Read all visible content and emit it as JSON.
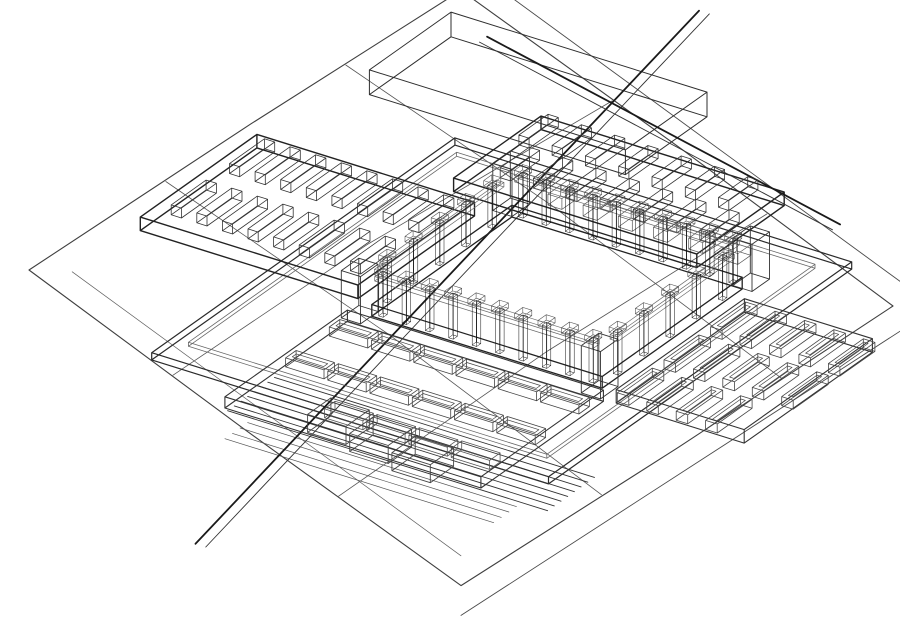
{
  "meta": {
    "title": "Axonometric wireframe site model",
    "description": "CAD hidden-line wireframe axonometric of a courtyard building complex on a terraced terrain diamond"
  },
  "canvas": {
    "width": 900,
    "height": 638,
    "background": "#ffffff"
  },
  "palette": {
    "line_dark": "#222222",
    "line_mid": "#4a4a4a",
    "line_light": "#6f6f6f",
    "column_fill": "#262626",
    "courtyard_fill": "#ffffff"
  },
  "groups": {
    "t": {
      "o": [
        461,
        288
      ],
      "a": [
        3.6,
        -2.33
      ],
      "b": [
        3.6,
        2.63
      ],
      "zs": 4.5
    },
    "b": {
      "o": [
        557,
        308
      ],
      "a": [
        6.4,
        2.0
      ],
      "b": [
        -5.83,
        4.13
      ],
      "zs": 4.5
    }
  },
  "elements": [
    {
      "k": "poly",
      "g": "t",
      "w": 1.1,
      "c": "#3f3f3f",
      "closed": true,
      "pts": [
        [
          -60,
          -60,
          0
        ],
        [
          2,
          -60.5,
          0
        ],
        [
          60,
          -60,
          0
        ],
        [
          60.5,
          1,
          0
        ],
        [
          60,
          60,
          0
        ],
        [
          0,
          60.5,
          0
        ],
        [
          -60,
          60,
          0
        ],
        [
          -60.4,
          0,
          0
        ]
      ]
    },
    {
      "k": "poly",
      "g": "t",
      "w": 0.9,
      "c": "#4a4a4a",
      "pts": [
        [
          66,
          -66,
          0
        ],
        [
          66,
          66,
          0
        ],
        [
          -66,
          66,
          0
        ]
      ]
    },
    {
      "k": "poly",
      "g": "t",
      "w": 0.8,
      "c": "#555555",
      "pts": [
        [
          -60,
          -20,
          0
        ],
        [
          -5,
          -21,
          0
        ],
        [
          60,
          -18,
          0
        ]
      ]
    },
    {
      "k": "poly",
      "g": "t",
      "w": 0.8,
      "c": "#555555",
      "pts": [
        [
          -60,
          26,
          0
        ],
        [
          0,
          24,
          0
        ],
        [
          60,
          25,
          0
        ]
      ]
    },
    {
      "k": "poly",
      "g": "t",
      "w": 0.8,
      "c": "#555555",
      "pts": [
        [
          -22,
          -60,
          0
        ],
        [
          -20,
          0,
          0
        ],
        [
          -21,
          60,
          0
        ]
      ]
    },
    {
      "k": "poly",
      "g": "t",
      "w": 0.8,
      "c": "#555555",
      "pts": [
        [
          28,
          -60,
          0
        ],
        [
          30,
          -5,
          0
        ],
        [
          29,
          60,
          0
        ]
      ]
    },
    {
      "k": "poly",
      "g": "t",
      "w": 0.7,
      "c": "#606060",
      "pts": [
        [
          -54,
          -54,
          0
        ],
        [
          -54,
          54,
          0
        ]
      ]
    },
    {
      "k": "box",
      "g": "b",
      "w": 1.2,
      "c": "#2a2a2a",
      "min": [
        -36,
        -22,
        0
      ],
      "size": [
        62,
        52,
        1.6
      ]
    },
    {
      "k": "box",
      "g": "b",
      "w": 0.8,
      "c": "#666666",
      "min": [
        -33,
        -19,
        1.6
      ],
      "size": [
        56,
        46,
        0.9
      ]
    },
    {
      "k": "lines",
      "g": "b",
      "w": 0.9,
      "c": "#333333",
      "from": [
        -20,
        26.5,
        0
      ],
      "to": [
        30,
        26.5,
        0
      ],
      "count": 8,
      "step": [
        0,
        1.15,
        0
      ]
    },
    {
      "k": "lines",
      "g": "b",
      "w": 0.7,
      "c": "#555555",
      "from": [
        -16,
        35.5,
        0
      ],
      "to": [
        26,
        35.5,
        0
      ],
      "count": 4,
      "step": [
        0,
        1.3,
        0
      ]
    },
    {
      "k": "box",
      "g": "b",
      "w": 1.4,
      "c": "#222222",
      "min": [
        -56,
        -10,
        1.5
      ],
      "size": [
        34,
        20,
        3
      ]
    },
    {
      "k": "box",
      "g": "b",
      "w": 1.4,
      "c": "#222222",
      "min": [
        -28,
        -28,
        1.5
      ],
      "size": [
        38,
        15,
        3
      ]
    },
    {
      "k": "box",
      "g": "b",
      "w": 1.1,
      "c": "#333333",
      "min": [
        22,
        -8,
        1.5
      ],
      "size": [
        20,
        22,
        3
      ]
    },
    {
      "k": "box",
      "g": "b",
      "w": 1.1,
      "c": "#333333",
      "min": [
        -20,
        14,
        1
      ],
      "size": [
        40,
        21,
        2.5
      ]
    },
    {
      "k": "box",
      "g": "b",
      "w": 1.0,
      "c": "#2e2e2e",
      "min": [
        -53,
        -40,
        0
      ],
      "size": [
        40,
        14,
        5.5
      ]
    },
    {
      "k": "poly",
      "g": "b",
      "w": 1.8,
      "c": "#1a1a1a",
      "pts": [
        [
          0,
          62,
          4.5
        ],
        [
          -27,
          -54,
          4.5
        ]
      ]
    },
    {
      "k": "poly",
      "g": "b",
      "w": 0.9,
      "c": "#333333",
      "pts": [
        [
          1.6,
          62,
          4.5
        ],
        [
          -25.4,
          -54,
          4.5
        ]
      ]
    },
    {
      "k": "poly",
      "g": "b",
      "w": 1.8,
      "c": "#1a1a1a",
      "pts": [
        [
          -46,
          -38.5,
          4.5
        ],
        [
          21,
          -25.5,
          4.5
        ]
      ]
    },
    {
      "k": "poly",
      "g": "b",
      "w": 0.9,
      "c": "#333333",
      "pts": [
        [
          -46,
          -37.2,
          4.5
        ],
        [
          21,
          -24.2,
          4.5
        ]
      ]
    },
    {
      "k": "row",
      "g": "b",
      "w": 0.8,
      "c": "#333333",
      "min": [
        -53,
        -8,
        4.5
      ],
      "size": [
        1.6,
        6,
        2.2
      ],
      "count": 8,
      "step": [
        4,
        0,
        0
      ]
    },
    {
      "k": "row",
      "g": "b",
      "w": 0.8,
      "c": "#333333",
      "min": [
        -53,
        2,
        4.5
      ],
      "size": [
        1.6,
        6,
        2.2
      ],
      "count": 8,
      "step": [
        4,
        0,
        0
      ]
    },
    {
      "k": "row",
      "g": "b",
      "w": 0.8,
      "c": "#333333",
      "min": [
        -26,
        -27,
        4.5
      ],
      "size": [
        1.6,
        5,
        2.2
      ],
      "count": 7,
      "step": [
        5.2,
        0,
        0
      ]
    },
    {
      "k": "row",
      "g": "b",
      "w": 0.8,
      "c": "#333333",
      "min": [
        -23,
        -20.5,
        4.5
      ],
      "size": [
        1.6,
        5,
        2.2
      ],
      "count": 7,
      "step": [
        5.2,
        0,
        0
      ]
    },
    {
      "k": "row",
      "g": "b",
      "w": 0.8,
      "c": "#444444",
      "inner": 0.55,
      "min": [
        24,
        -6,
        4.5
      ],
      "size": [
        1.8,
        6,
        2
      ],
      "count": 5,
      "step": [
        4.6,
        0,
        0
      ]
    },
    {
      "k": "row",
      "g": "b",
      "w": 0.8,
      "c": "#444444",
      "inner": 0.55,
      "min": [
        24,
        2,
        4.5
      ],
      "size": [
        1.8,
        6,
        2
      ],
      "count": 5,
      "step": [
        4.6,
        0,
        0
      ]
    },
    {
      "k": "row",
      "g": "b",
      "w": 0.8,
      "c": "#444444",
      "inner": 0.55,
      "min": [
        24,
        10,
        4.5
      ],
      "size": [
        1.8,
        6,
        2
      ],
      "count": 4,
      "step": [
        4.6,
        0,
        0
      ]
    },
    {
      "k": "row",
      "g": "b",
      "w": 0.8,
      "c": "#444444",
      "inner": 0.55,
      "min": [
        -18,
        17.5,
        3.5
      ],
      "size": [
        6,
        1.8,
        2
      ],
      "count": 6,
      "step": [
        6.6,
        0,
        0
      ]
    },
    {
      "k": "row",
      "g": "b",
      "w": 0.8,
      "c": "#444444",
      "inner": 0.55,
      "min": [
        -18,
        25,
        3.5
      ],
      "size": [
        6,
        1.8,
        2
      ],
      "count": 6,
      "step": [
        6.6,
        0,
        0
      ]
    },
    {
      "k": "row",
      "g": "b",
      "w": 0.8,
      "c": "#555555",
      "min": [
        -6,
        31.5,
        3.5
      ],
      "size": [
        6,
        1.8,
        2
      ],
      "count": 4,
      "step": [
        6.6,
        0,
        0
      ]
    },
    {
      "k": "row",
      "g": "b",
      "w": 0.7,
      "c": "#555555",
      "min": [
        -14,
        -16,
        4
      ],
      "size": [
        2.2,
        2.2,
        2.4
      ],
      "count": 6,
      "step": [
        5.5,
        0,
        0
      ]
    },
    {
      "k": "row",
      "g": "b",
      "w": 0.9,
      "c": "#444444",
      "min": [
        -8,
        30,
        0
      ],
      "size": [
        6,
        4,
        4
      ],
      "count": 3,
      "step": [
        7.5,
        1,
        0
      ]
    },
    {
      "k": "box",
      "g": "b",
      "w": 1.3,
      "c": "#222222",
      "topFill": "#ffffff",
      "min": [
        -18,
        -12,
        1.2
      ],
      "size": [
        36,
        24,
        2.6
      ]
    },
    {
      "k": "box",
      "g": "b",
      "w": 0.9,
      "c": "#333333",
      "min": [
        -20.5,
        -14.5,
        2
      ],
      "size": [
        3,
        3,
        10.5
      ]
    },
    {
      "k": "box",
      "g": "b",
      "w": 0.9,
      "c": "#333333",
      "min": [
        17,
        -14.5,
        2
      ],
      "size": [
        3,
        3,
        10.5
      ]
    },
    {
      "k": "box",
      "g": "b",
      "w": 0.9,
      "c": "#333333",
      "min": [
        -20.5,
        11.5,
        2
      ],
      "size": [
        3,
        3,
        10.5
      ]
    },
    {
      "k": "box",
      "g": "b",
      "w": 0.9,
      "c": "#333333",
      "min": [
        17,
        11.5,
        2
      ],
      "size": [
        3,
        3,
        10.5
      ]
    },
    {
      "k": "box",
      "g": "b",
      "w": 0.7,
      "c": "#666666",
      "min": [
        -17,
        -12.6,
        10
      ],
      "size": [
        34,
        1.2,
        1
      ]
    },
    {
      "k": "box",
      "g": "b",
      "w": 0.7,
      "c": "#666666",
      "min": [
        -17,
        11.4,
        10
      ],
      "size": [
        34,
        1.2,
        1
      ]
    },
    {
      "k": "box",
      "g": "b",
      "w": 0.7,
      "c": "#666666",
      "min": [
        -18.6,
        -10,
        10
      ],
      "size": [
        1.2,
        20,
        1
      ]
    },
    {
      "k": "box",
      "g": "b",
      "w": 0.7,
      "c": "#666666",
      "min": [
        17.4,
        -10,
        10
      ],
      "size": [
        1.2,
        20,
        1
      ]
    },
    {
      "k": "row",
      "g": "b",
      "w": 0.5,
      "c": "#111111",
      "fill": "#262626",
      "min": [
        -16.6,
        -12.35,
        2.2
      ],
      "size": [
        0.7,
        0.7,
        9.3
      ],
      "count": 10,
      "step": [
        3.65,
        0,
        0
      ]
    },
    {
      "k": "row",
      "g": "b",
      "w": 0.5,
      "c": "#111111",
      "fill": "#262626",
      "min": [
        -16.6,
        11.65,
        2.2
      ],
      "size": [
        0.7,
        0.7,
        9.3
      ],
      "count": 10,
      "step": [
        3.65,
        0,
        0
      ]
    },
    {
      "k": "row",
      "g": "b",
      "w": 0.5,
      "c": "#111111",
      "fill": "#262626",
      "min": [
        -18.35,
        -9,
        2.2
      ],
      "size": [
        0.7,
        0.7,
        9.3
      ],
      "count": 5,
      "step": [
        0,
        4.5,
        0
      ]
    },
    {
      "k": "row",
      "g": "b",
      "w": 0.5,
      "c": "#111111",
      "fill": "#262626",
      "min": [
        17.65,
        -9,
        2.2
      ],
      "size": [
        0.7,
        0.7,
        9.3
      ],
      "count": 5,
      "step": [
        0,
        4.5,
        0
      ]
    },
    {
      "k": "row",
      "g": "b",
      "w": 0.6,
      "c": "#555555",
      "min": [
        -16.95,
        -12.7,
        11.5
      ],
      "size": [
        1.4,
        1.4,
        1.2
      ],
      "count": 10,
      "step": [
        3.65,
        0,
        0
      ]
    },
    {
      "k": "row",
      "g": "b",
      "w": 0.6,
      "c": "#555555",
      "min": [
        -16.95,
        11.3,
        11.5
      ],
      "size": [
        1.4,
        1.4,
        1.2
      ],
      "count": 10,
      "step": [
        3.65,
        0,
        0
      ]
    },
    {
      "k": "row",
      "g": "b",
      "w": 0.6,
      "c": "#555555",
      "min": [
        -18.7,
        -9.35,
        11.5
      ],
      "size": [
        1.4,
        1.4,
        1.2
      ],
      "count": 5,
      "step": [
        0,
        4.5,
        0
      ]
    },
    {
      "k": "row",
      "g": "b",
      "w": 0.6,
      "c": "#555555",
      "min": [
        17.3,
        -9.35,
        11.5
      ],
      "size": [
        1.4,
        1.4,
        1.2
      ],
      "count": 5,
      "step": [
        0,
        4.5,
        0
      ]
    }
  ]
}
